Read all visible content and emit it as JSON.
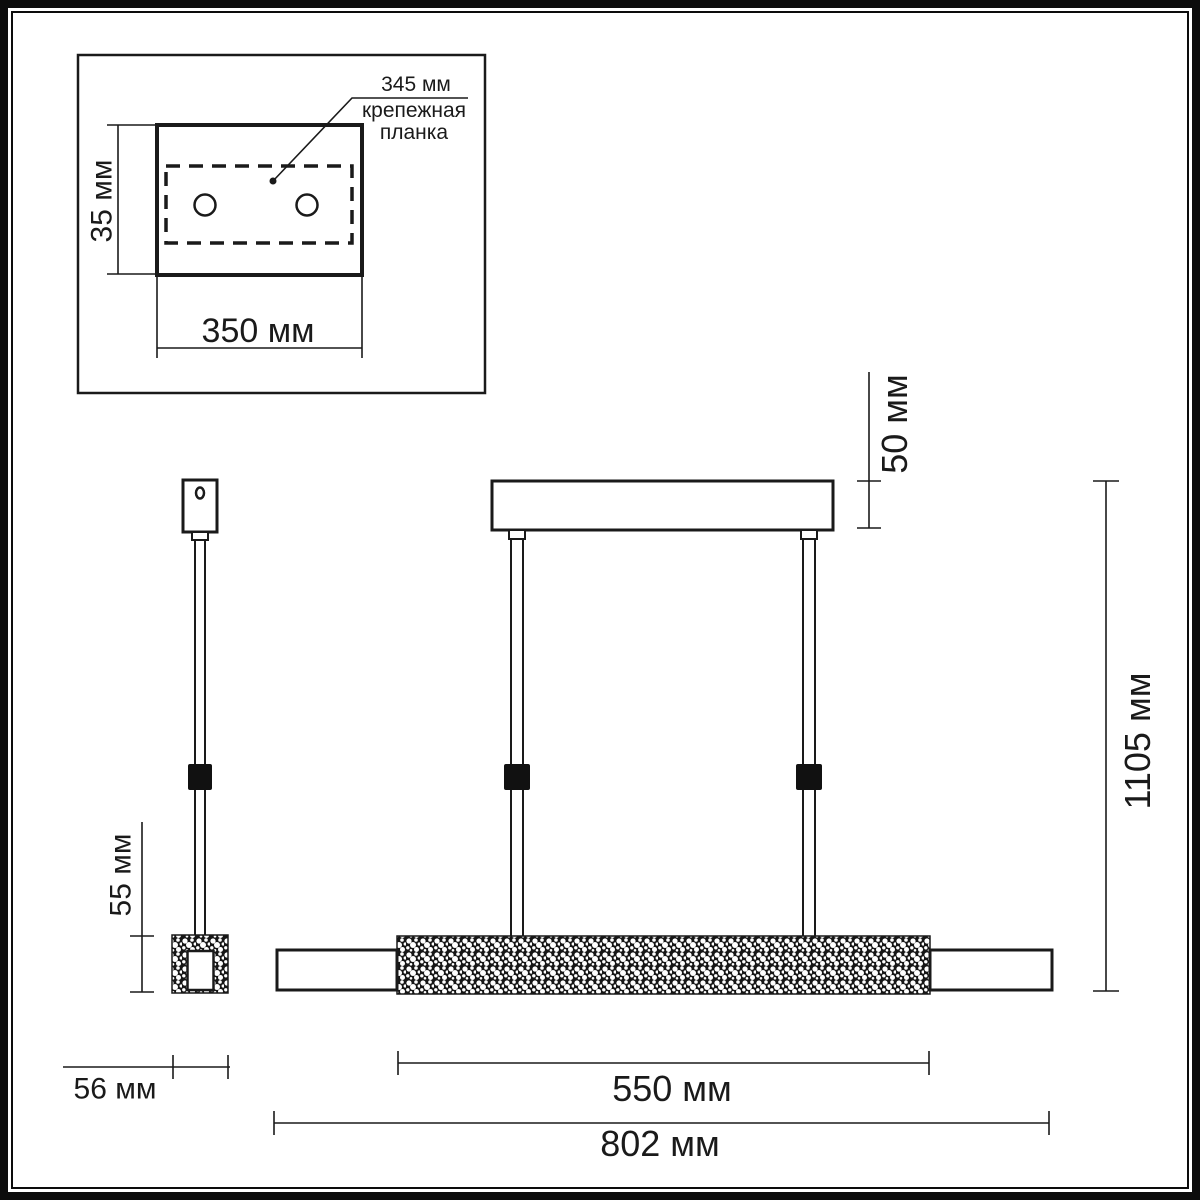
{
  "drawing": {
    "title_none": "",
    "inset_detail": {
      "plate_span_label": "345 мм",
      "plate_name_line1": "крепежная",
      "plate_name_line2": "планка",
      "canopy_height_label": "35 мм",
      "canopy_width_label": "350 мм"
    },
    "side_view": {
      "tube_height_label": "55 мм",
      "tube_width_label": "56 мм"
    },
    "front_view": {
      "ceiling_bar_height_label": "50 мм",
      "overall_drop_label": "1105 мм",
      "crystal_section_label": "550 мм",
      "overall_length_label": "802 мм"
    },
    "units": "мм",
    "colors": {
      "line": "#1a1a1a",
      "frame": "#0c0c0c",
      "background": "#ffffff",
      "connector_fill": "#111111",
      "texture_fill": "#161616"
    }
  }
}
